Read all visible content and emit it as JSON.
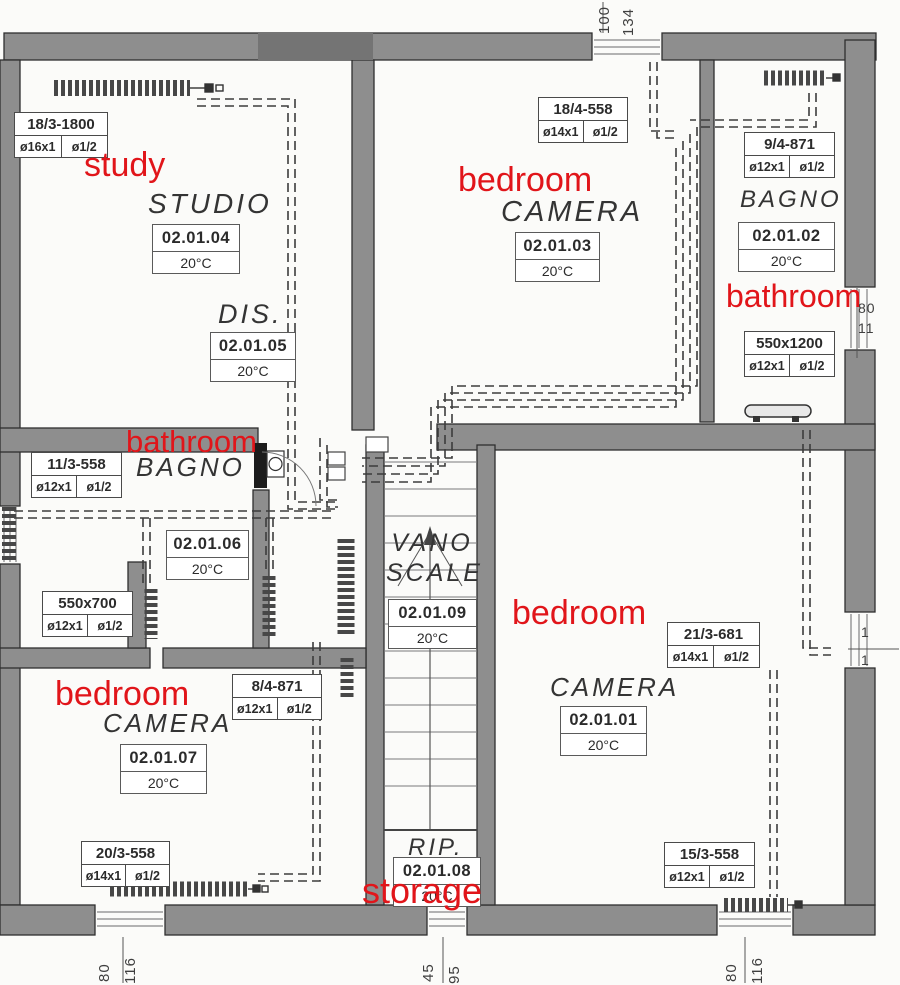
{
  "colors": {
    "annotation_red": "#e1151a",
    "wall_gray": "#8e8e8e",
    "paper": "#fbfbf9"
  },
  "rooms": [
    {
      "key": "study",
      "name_it": "STUDIO",
      "note_en": "study",
      "code": "02.01.04",
      "temp": "20°C"
    },
    {
      "key": "hallway",
      "name_it": "DIS.",
      "note_en": "",
      "code": "02.01.05",
      "temp": "20°C"
    },
    {
      "key": "bedroom-top",
      "name_it": "CAMERA",
      "note_en": "bedroom",
      "code": "02.01.03",
      "temp": "20°C"
    },
    {
      "key": "bathroom-top-right",
      "name_it": "BAGNO",
      "note_en": "bathroom",
      "code": "02.01.02",
      "temp": "20°C"
    },
    {
      "key": "bathroom-left",
      "name_it": "BAGNO",
      "note_en": "bathroom",
      "code": "02.01.06",
      "temp": "20°C"
    },
    {
      "key": "stairwell",
      "name_it": "VANO SCALE",
      "note_en": "",
      "code": "02.01.09",
      "temp": "20°C"
    },
    {
      "key": "bedroom-right",
      "name_it": "CAMERA",
      "note_en": "bedroom",
      "code": "02.01.01",
      "temp": "20°C"
    },
    {
      "key": "bedroom-bottom-left",
      "name_it": "CAMERA",
      "note_en": "bedroom",
      "code": "02.01.07",
      "temp": "20°C"
    },
    {
      "key": "storage",
      "name_it": "RIP.",
      "note_en": "storage",
      "code": "02.01.08",
      "temp": "20°C"
    }
  ],
  "radiators": [
    {
      "model": "18/3-1800",
      "pipe": "ø16x1",
      "conn": "ø1/2"
    },
    {
      "model": "18/4-558",
      "pipe": "ø14x1",
      "conn": "ø1/2"
    },
    {
      "model": "9/4-871",
      "pipe": "ø12x1",
      "conn": "ø1/2"
    },
    {
      "model": "550x1200",
      "pipe": "ø12x1",
      "conn": "ø1/2"
    },
    {
      "model": "11/3-558",
      "pipe": "ø12x1",
      "conn": "ø1/2"
    },
    {
      "model": "550x700",
      "pipe": "ø12x1",
      "conn": "ø1/2"
    },
    {
      "model": "8/4-871",
      "pipe": "ø12x1",
      "conn": "ø1/2"
    },
    {
      "model": "21/3-681",
      "pipe": "ø14x1",
      "conn": "ø1/2"
    },
    {
      "model": "20/3-558",
      "pipe": "ø14x1",
      "conn": "ø1/2"
    },
    {
      "model": "15/3-558",
      "pipe": "ø12x1",
      "conn": "ø1/2"
    }
  ],
  "dimensions": {
    "top_window": [
      "100",
      "134"
    ],
    "bottom_left_window": [
      "80",
      "116"
    ],
    "bottom_center_window": [
      "45",
      "95"
    ],
    "bottom_right_window": [
      "80",
      "116"
    ],
    "right_upper_window": [
      "80",
      "11"
    ],
    "right_lower_window": [
      "1",
      "1"
    ]
  }
}
